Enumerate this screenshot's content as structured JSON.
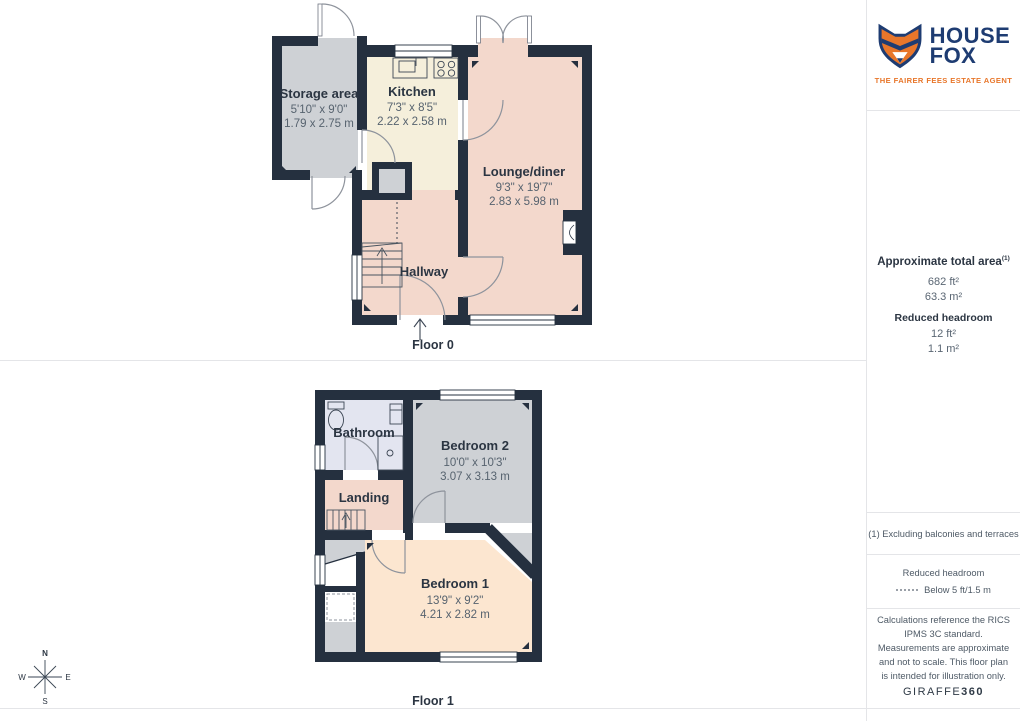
{
  "branding": {
    "house": "HOUSE",
    "fox": "FOX",
    "tagline": "THE FAIRER FEES ESTATE AGENT",
    "giraffe": "GIRAFFE",
    "giraffe360": "360"
  },
  "sidebar": {
    "total_area_title": "Approximate total area",
    "total_area_sup": "(1)",
    "total_area_ft": "682 ft²",
    "total_area_m": "63.3 m²",
    "reduced_title": "Reduced headroom",
    "reduced_ft": "12 ft²",
    "reduced_m": "1.1 m²",
    "footnote": "(1) Excluding balconies and terraces",
    "legend_title": "Reduced headroom",
    "legend_value": "Below 5 ft/1.5 m",
    "disclaimer": "Calculations reference the RICS IPMS 3C standard. Measurements are approximate and not to scale. This floor plan is intended for illustration only."
  },
  "floor0": {
    "label": "Floor 0",
    "storage": {
      "name": "Storage area",
      "imperial": "5'10\" x 9'0\"",
      "metric": "1.79 x 2.75 m"
    },
    "kitchen": {
      "name": "Kitchen",
      "imperial": "7'3\" x 8'5\"",
      "metric": "2.22 x 2.58 m"
    },
    "lounge": {
      "name": "Lounge/diner",
      "imperial": "9'3\" x 19'7\"",
      "metric": "2.83 x 5.98 m"
    },
    "hallway": {
      "name": "Hallway"
    }
  },
  "floor1": {
    "label": "Floor 1",
    "bathroom": {
      "name": "Bathroom"
    },
    "bedroom2": {
      "name": "Bedroom 2",
      "imperial": "10'0\" x 10'3\"",
      "metric": "3.07 x 3.13 m"
    },
    "landing": {
      "name": "Landing"
    },
    "bedroom1": {
      "name": "Bedroom 1",
      "imperial": "13'9\" x 9'2\"",
      "metric": "4.21 x 2.82 m"
    }
  },
  "compass": {
    "north": "N",
    "east": "E",
    "south": "S",
    "west": "W"
  },
  "colors": {
    "wall": "#25303f",
    "lounge_pink": "#f3d8cc",
    "bedroom_peach": "#fce6d0",
    "kitchen_cream": "#f5efdb",
    "room_gray": "#ced1d5",
    "bathroom_lavender": "#e3e5f0",
    "logo_navy": "#1e3c72",
    "logo_orange": "#e8762a"
  }
}
